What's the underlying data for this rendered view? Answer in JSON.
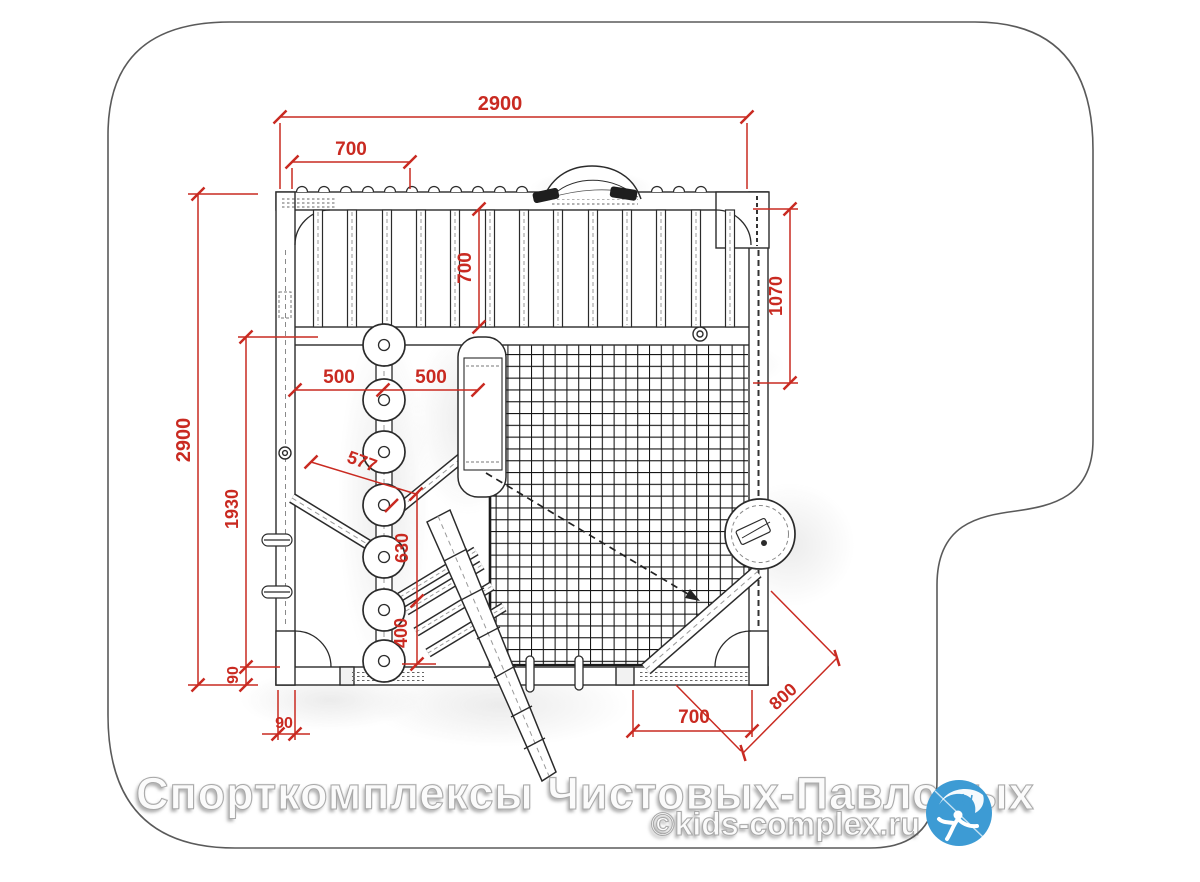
{
  "watermark": {
    "line1": "Спорткомплексы Чистовых-Павловых",
    "line2": "©kids-complex.ru"
  },
  "logo": {
    "label": "kids-complex-logo",
    "background": "#3d9bd4"
  },
  "drawing": {
    "type": "playground-sportcomplex-top-view-plan",
    "units": "mm",
    "dimension_color": "#c92a21",
    "outline_color": "#2b2b2b",
    "dims": {
      "overall_width": "2900",
      "top_segment": "700",
      "rung_bay_depth": "700",
      "right_side_offset": "1070",
      "overall_depth": "2900",
      "left_inner_depth": "1930",
      "disc_left": "500",
      "disc_right": "500",
      "incline_bar": "577",
      "stairs_run": "630",
      "ladder_run": "400",
      "post_width_left": "90",
      "post_width_bottom": "90",
      "bottom_right_bay": "700",
      "corner_diagonal": "800"
    }
  }
}
